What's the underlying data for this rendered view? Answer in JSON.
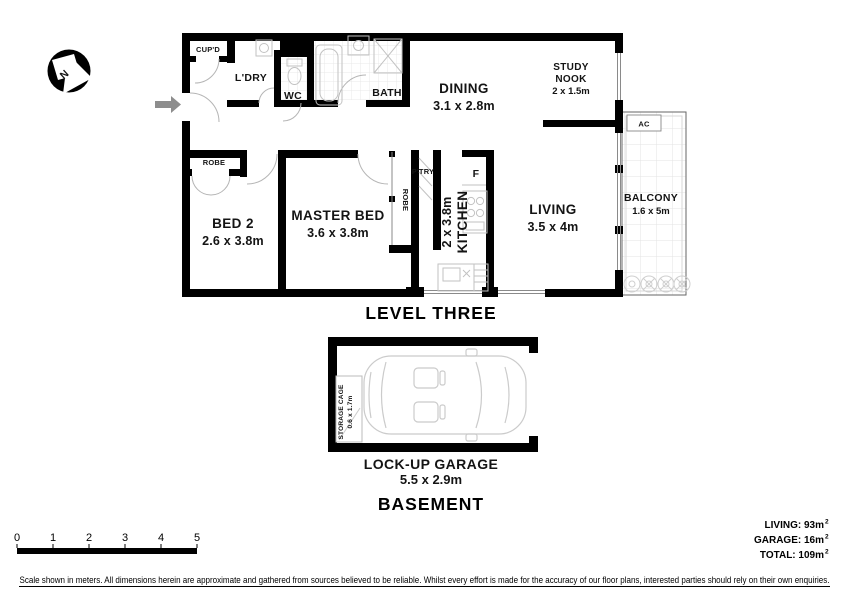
{
  "compass": {
    "letter": "N"
  },
  "level3": {
    "title": "LEVEL THREE",
    "rooms": {
      "cupd": "CUP'D",
      "ldry": "L'DRY",
      "wc": "WC",
      "bath": "BATH",
      "dining_name": "DINING",
      "dining_dims": "3.1 x 2.8m",
      "study1": "STUDY",
      "study2": "NOOK",
      "study_dims": "2 x 1.5m",
      "bed2_name": "BED 2",
      "bed2_dims": "2.6 x 3.8m",
      "master_name": "MASTER BED",
      "master_dims": "3.6 x 3.8m",
      "kitchen_name": "KITCHEN",
      "kitchen_dims": "2 x 3.8m",
      "living_name": "LIVING",
      "living_dims": "3.5 x 4m",
      "balcony_name": "BALCONY",
      "balcony_dims": "1.6 x 5m",
      "robe_bed2": "ROBE",
      "robe_master": "ROBE",
      "pantry": "P'TRY",
      "fridge": "F",
      "ac": "AC"
    }
  },
  "basement": {
    "title": "BASEMENT",
    "garage_name": "LOCK-UP GARAGE",
    "garage_dims": "5.5 x 2.9m",
    "storage_line1": "STORAGE CAGE",
    "storage_line2": "0.6 x 1.7m"
  },
  "scale": {
    "ticks": [
      "0",
      "1",
      "2",
      "3",
      "4",
      "5"
    ]
  },
  "areas": {
    "living_text": "LIVING:  93m",
    "living_sup": "2",
    "garage_text": "GARAGE:  16m",
    "garage_sup": "2",
    "total_text": "TOTAL:  109m",
    "total_sup": "2"
  },
  "disclaimer": "Scale shown in meters. All dimensions herein are approximate and gathered from sources believed to be  reliable. Whilst every effort is made for the accuracy of our floor plans, interested parties should rely on their own enquiries.",
  "colors": {
    "wall": "#000000",
    "fixture": "#c2c2c2",
    "entry_arrow": "#8d8d8d",
    "background": "#ffffff"
  }
}
